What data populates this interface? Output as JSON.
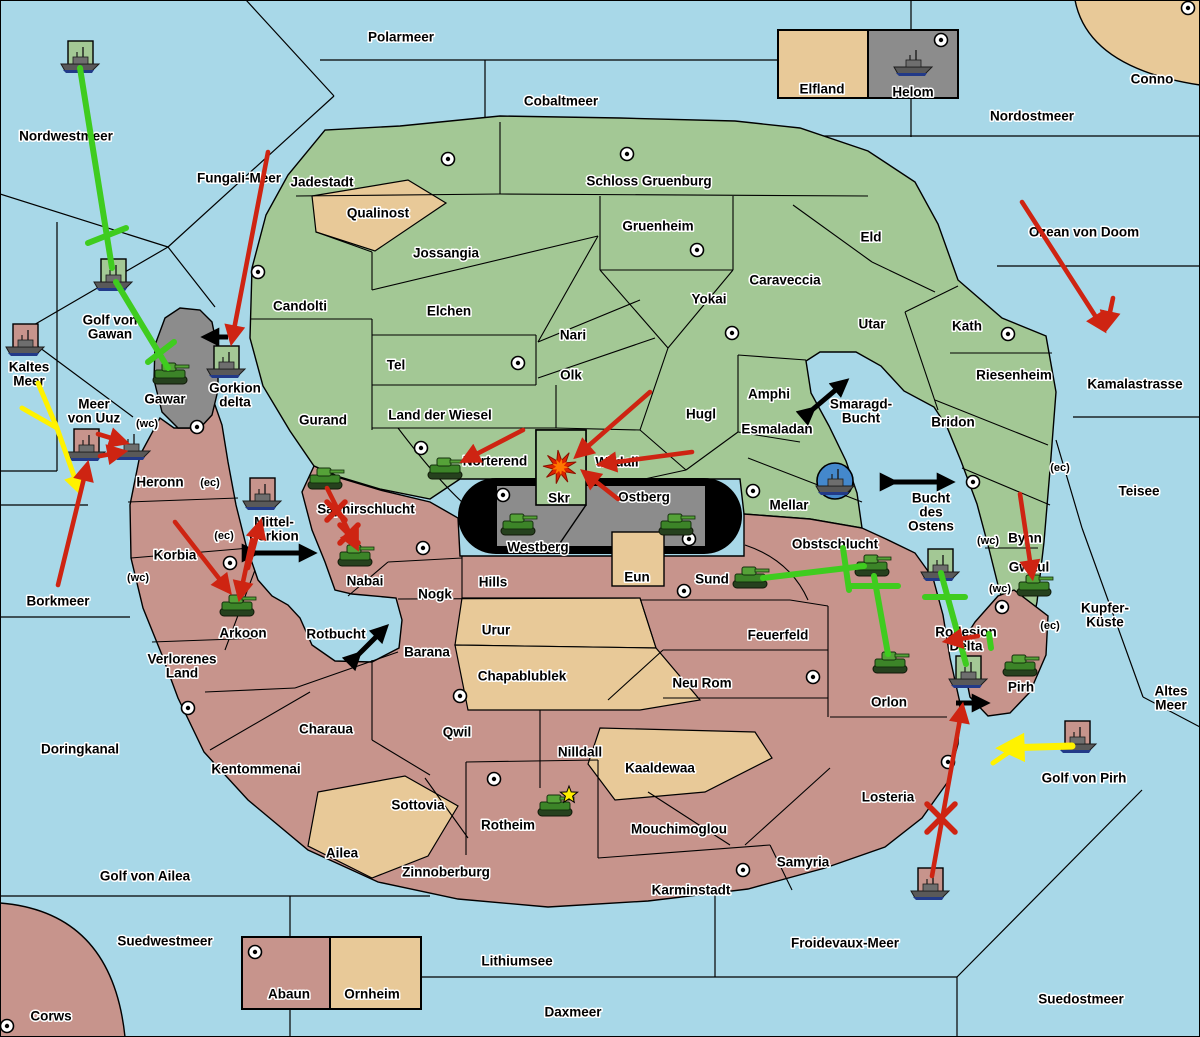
{
  "title": "Strategy map",
  "colors": {
    "water": "#A8D8E8",
    "green_land": "#A3C895",
    "red_land": "#C7948C",
    "tan_land": "#E8C998",
    "gray_land": "#8C8C8C",
    "border": "#000000",
    "attack_red": "#CE2412",
    "support_green": "#3FCC1F",
    "convoy_yellow": "#FFF200",
    "exchange_black": "#000000",
    "unit_fleet": "#5A5A5A",
    "unit_army": "#3C8428",
    "harbor_blue": "#4488CC"
  },
  "sea_labels": [
    {
      "t": "Polarmeer",
      "x": 401,
      "y": 38
    },
    {
      "t": "Cobaltmeer",
      "x": 561,
      "y": 102
    },
    {
      "t": "Nordostmeer",
      "x": 1032,
      "y": 117
    },
    {
      "t": "Nordwestmeer",
      "x": 66,
      "y": 137
    },
    {
      "t": "Fungali-Meer",
      "x": 239,
      "y": 179
    },
    {
      "t": "Ozean von Doom",
      "x": 1084,
      "y": 233
    },
    {
      "t": "Kaltes",
      "l2": "Meer",
      "x": 29,
      "y": 375
    },
    {
      "t": "Golf von",
      "l2": "Gawan",
      "x": 110,
      "y": 328
    },
    {
      "t": "Meer",
      "l2": "von Uuz",
      "x": 94,
      "y": 412
    },
    {
      "t": "Gorkion",
      "l2": "delta",
      "x": 235,
      "y": 396
    },
    {
      "t": "Mittel-",
      "l2": "gorkion",
      "x": 274,
      "y": 530
    },
    {
      "t": "Kamalastrasse",
      "x": 1135,
      "y": 385
    },
    {
      "t": "Teisee",
      "x": 1139,
      "y": 492
    },
    {
      "t": "Borkmeer",
      "x": 58,
      "y": 602
    },
    {
      "t": "Kupfer-",
      "l2": "Küste",
      "x": 1105,
      "y": 616
    },
    {
      "t": "Altes",
      "l2": "Meer",
      "x": 1171,
      "y": 699
    },
    {
      "t": "Golf von Pirh",
      "x": 1084,
      "y": 779
    },
    {
      "t": "Doringkanal",
      "x": 80,
      "y": 750
    },
    {
      "t": "Golf von Ailea",
      "x": 145,
      "y": 877
    },
    {
      "t": "Suedwestmeer",
      "x": 165,
      "y": 942
    },
    {
      "t": "Froidevaux-Meer",
      "x": 845,
      "y": 944
    },
    {
      "t": "Lithiumsee",
      "x": 517,
      "y": 962
    },
    {
      "t": "Daxmeer",
      "x": 573,
      "y": 1013
    },
    {
      "t": "Suedostmeer",
      "x": 1081,
      "y": 1000
    },
    {
      "t": "Smaragd-",
      "l2": "Bucht",
      "x": 861,
      "y": 412
    },
    {
      "t": "Bucht",
      "l2": "des",
      "l3": "Ostens",
      "x": 931,
      "y": 513
    },
    {
      "t": "Rotbucht",
      "x": 336,
      "y": 635
    }
  ],
  "province_labels": [
    {
      "t": "Jadestadt",
      "x": 322,
      "y": 183
    },
    {
      "t": "Schloss Gruenburg",
      "x": 649,
      "y": 182
    },
    {
      "t": "Qualinost",
      "x": 378,
      "y": 214
    },
    {
      "t": "Jossangia",
      "x": 446,
      "y": 254
    },
    {
      "t": "Gruenheim",
      "x": 658,
      "y": 227
    },
    {
      "t": "Eld",
      "x": 871,
      "y": 238
    },
    {
      "t": "Caraveccia",
      "x": 785,
      "y": 281
    },
    {
      "t": "Yokai",
      "x": 709,
      "y": 300
    },
    {
      "t": "Candolti",
      "x": 300,
      "y": 307
    },
    {
      "t": "Elchen",
      "x": 449,
      "y": 312
    },
    {
      "t": "Nari",
      "x": 573,
      "y": 336
    },
    {
      "t": "Utar",
      "x": 872,
      "y": 325
    },
    {
      "t": "Kath",
      "x": 967,
      "y": 327
    },
    {
      "t": "Tel",
      "x": 396,
      "y": 366
    },
    {
      "t": "Olk",
      "x": 571,
      "y": 376
    },
    {
      "t": "Riesenheim",
      "x": 1014,
      "y": 376
    },
    {
      "t": "Land der Wiesel",
      "x": 440,
      "y": 416
    },
    {
      "t": "Gurand",
      "x": 323,
      "y": 421
    },
    {
      "t": "Hugl",
      "x": 701,
      "y": 415
    },
    {
      "t": "Amphi",
      "x": 769,
      "y": 395
    },
    {
      "t": "Bridon",
      "x": 953,
      "y": 423
    },
    {
      "t": "Esmaladan",
      "x": 777,
      "y": 430
    },
    {
      "t": "Norterend",
      "x": 495,
      "y": 462
    },
    {
      "t": "Wildall",
      "x": 617,
      "y": 463
    },
    {
      "t": "Mellar",
      "x": 789,
      "y": 506
    },
    {
      "t": "Bynn",
      "x": 1025,
      "y": 539
    },
    {
      "t": "Gwaul",
      "x": 1029,
      "y": 568
    },
    {
      "t": "Gawar",
      "x": 165,
      "y": 400
    },
    {
      "t": "Westberg",
      "x": 538,
      "y": 548
    },
    {
      "t": "Ostberg",
      "x": 644,
      "y": 498
    },
    {
      "t": "Skr",
      "x": 559,
      "y": 499
    },
    {
      "t": "Helom",
      "x": 913,
      "y": 93
    },
    {
      "t": "Elfland",
      "x": 822,
      "y": 90
    },
    {
      "t": "Conno",
      "x": 1152,
      "y": 80
    },
    {
      "t": "Heronn",
      "x": 160,
      "y": 483
    },
    {
      "t": "Korbia",
      "x": 175,
      "y": 556
    },
    {
      "t": "Saphirschlucht",
      "x": 366,
      "y": 510
    },
    {
      "t": "Nabai",
      "x": 365,
      "y": 582
    },
    {
      "t": "Arkoon",
      "x": 243,
      "y": 634
    },
    {
      "t": "Verlorenes",
      "l2": "Land",
      "x": 182,
      "y": 667
    },
    {
      "t": "Charaua",
      "x": 326,
      "y": 730
    },
    {
      "t": "Kentommenai",
      "x": 256,
      "y": 770
    },
    {
      "t": "Nogk",
      "x": 435,
      "y": 595
    },
    {
      "t": "Hills",
      "x": 493,
      "y": 583
    },
    {
      "t": "Urur",
      "x": 496,
      "y": 631
    },
    {
      "t": "Barana",
      "x": 427,
      "y": 653
    },
    {
      "t": "Chapablublek",
      "x": 522,
      "y": 677
    },
    {
      "t": "Qwil",
      "x": 457,
      "y": 733
    },
    {
      "t": "Sottovia",
      "x": 418,
      "y": 806
    },
    {
      "t": "Ailea",
      "x": 342,
      "y": 854
    },
    {
      "t": "Zinnoberburg",
      "x": 446,
      "y": 873
    },
    {
      "t": "Rotheim",
      "x": 508,
      "y": 826
    },
    {
      "t": "Nilldall",
      "x": 580,
      "y": 753
    },
    {
      "t": "Kaaldewaa",
      "x": 660,
      "y": 769
    },
    {
      "t": "Mouchimoglou",
      "x": 679,
      "y": 830
    },
    {
      "t": "Karminstadt",
      "x": 691,
      "y": 891
    },
    {
      "t": "Samyria",
      "x": 803,
      "y": 863
    },
    {
      "t": "Neu Rom",
      "x": 702,
      "y": 684
    },
    {
      "t": "Feuerfeld",
      "x": 778,
      "y": 636
    },
    {
      "t": "Eun",
      "x": 637,
      "y": 578
    },
    {
      "t": "Sund",
      "x": 712,
      "y": 580
    },
    {
      "t": "Obstschlucht",
      "x": 835,
      "y": 545
    },
    {
      "t": "Orlon",
      "x": 889,
      "y": 703
    },
    {
      "t": "Losteria",
      "x": 888,
      "y": 798
    },
    {
      "t": "Rodesion",
      "l2": "Delta",
      "x": 966,
      "y": 640
    },
    {
      "t": "Pirh",
      "x": 1021,
      "y": 688
    },
    {
      "t": "Abaun",
      "x": 289,
      "y": 995
    },
    {
      "t": "Ornheim",
      "x": 372,
      "y": 995
    },
    {
      "t": "Corws",
      "x": 51,
      "y": 1017
    }
  ],
  "coast_markers": [
    {
      "t": "(wc)",
      "x": 147,
      "y": 424
    },
    {
      "t": "(ec)",
      "x": 210,
      "y": 483
    },
    {
      "t": "(ec)",
      "x": 224,
      "y": 536
    },
    {
      "t": "(wc)",
      "x": 138,
      "y": 578
    },
    {
      "t": "(ec)",
      "x": 1060,
      "y": 468
    },
    {
      "t": "(wc)",
      "x": 988,
      "y": 541
    },
    {
      "t": "(wc)",
      "x": 1000,
      "y": 589
    },
    {
      "t": "(ec)",
      "x": 1050,
      "y": 626
    }
  ],
  "supply_centers": [
    [
      448,
      159
    ],
    [
      627,
      154
    ],
    [
      697,
      250
    ],
    [
      1188,
      8
    ],
    [
      941,
      40
    ],
    [
      258,
      272
    ],
    [
      518,
      363
    ],
    [
      732,
      333
    ],
    [
      1008,
      334
    ],
    [
      421,
      448
    ],
    [
      753,
      491
    ],
    [
      197,
      427
    ],
    [
      503,
      495
    ],
    [
      689,
      539
    ],
    [
      684,
      591
    ],
    [
      423,
      548
    ],
    [
      230,
      563
    ],
    [
      188,
      708
    ],
    [
      460,
      696
    ],
    [
      494,
      779
    ],
    [
      743,
      870
    ],
    [
      813,
      677
    ],
    [
      948,
      762
    ],
    [
      1002,
      607
    ],
    [
      973,
      482
    ],
    [
      255,
      952
    ],
    [
      7,
      1026
    ]
  ],
  "units": {
    "armies": [
      [
        170,
        373
      ],
      [
        325,
        478
      ],
      [
        355,
        555
      ],
      [
        237,
        605
      ],
      [
        445,
        468
      ],
      [
        518,
        524
      ],
      [
        676,
        524
      ],
      [
        750,
        577
      ],
      [
        872,
        565
      ],
      [
        890,
        662
      ],
      [
        1034,
        585
      ],
      [
        1020,
        665
      ],
      [
        555,
        805
      ]
    ],
    "fleets": [
      [
        80,
        57,
        "g"
      ],
      [
        113,
        275,
        "g"
      ],
      [
        25,
        340,
        "r"
      ],
      [
        86,
        445,
        "r"
      ],
      [
        131,
        444,
        ""
      ],
      [
        226,
        362,
        "g"
      ],
      [
        262,
        494,
        "r"
      ],
      [
        835,
        479,
        "b"
      ],
      [
        940,
        565,
        "g"
      ],
      [
        968,
        672,
        "g"
      ],
      [
        1077,
        737,
        "r"
      ],
      [
        930,
        884,
        "r"
      ],
      [
        913,
        60,
        ""
      ]
    ]
  },
  "orders": {
    "attack_red": [
      [
        268,
        152,
        232,
        340
      ],
      [
        1022,
        202,
        1103,
        328
      ],
      [
        1113,
        298,
        1107,
        326
      ],
      [
        650,
        392,
        578,
        455
      ],
      [
        692,
        452,
        602,
        464
      ],
      [
        523,
        430,
        465,
        460
      ],
      [
        618,
        499,
        585,
        473
      ],
      [
        327,
        488,
        356,
        546
      ],
      [
        175,
        522,
        228,
        590
      ],
      [
        252,
        540,
        240,
        596
      ],
      [
        248,
        568,
        260,
        524
      ],
      [
        58,
        585,
        87,
        466
      ],
      [
        98,
        434,
        124,
        442
      ],
      [
        100,
        456,
        122,
        452
      ],
      [
        1020,
        494,
        1032,
        575
      ],
      [
        932,
        876,
        962,
        708
      ],
      [
        978,
        636,
        948,
        641
      ]
    ],
    "support_green": [
      [
        80,
        68,
        112,
        268
      ],
      [
        116,
        282,
        168,
        368
      ],
      [
        763,
        578,
        864,
        566
      ],
      [
        874,
        576,
        888,
        654
      ],
      [
        941,
        573,
        966,
        664
      ]
    ],
    "support_cut_bars": [
      [
        88,
        243,
        126,
        228
      ],
      [
        148,
        362,
        174,
        342
      ],
      [
        843,
        548,
        849,
        590
      ],
      [
        850,
        586,
        898,
        586
      ],
      [
        925,
        597,
        965,
        597
      ],
      [
        989,
        634,
        991,
        648
      ]
    ],
    "convoy_yellow": [
      [
        38,
        383,
        57,
        428,
        0,
        5
      ],
      [
        22,
        408,
        57,
        428,
        0,
        5
      ],
      [
        57,
        428,
        79,
        490,
        1,
        5
      ],
      [
        1072,
        746,
        1004,
        748,
        1,
        7
      ],
      [
        1022,
        743,
        993,
        763,
        0,
        5
      ]
    ],
    "exchange_black": [
      [
        228,
        337,
        206,
        337,
        1
      ],
      [
        255,
        553,
        312,
        553,
        2
      ],
      [
        812,
        410,
        845,
        382,
        2
      ],
      [
        893,
        482,
        950,
        482,
        2
      ],
      [
        358,
        655,
        385,
        628,
        2
      ],
      [
        956,
        703,
        985,
        703,
        1
      ]
    ],
    "failed_x_red": [
      [
        336,
        511,
        9
      ],
      [
        349,
        534,
        9
      ],
      [
        941,
        818,
        14
      ]
    ],
    "battle_explosion": [
      560,
      467
    ],
    "victory_star": [
      569,
      795
    ]
  }
}
